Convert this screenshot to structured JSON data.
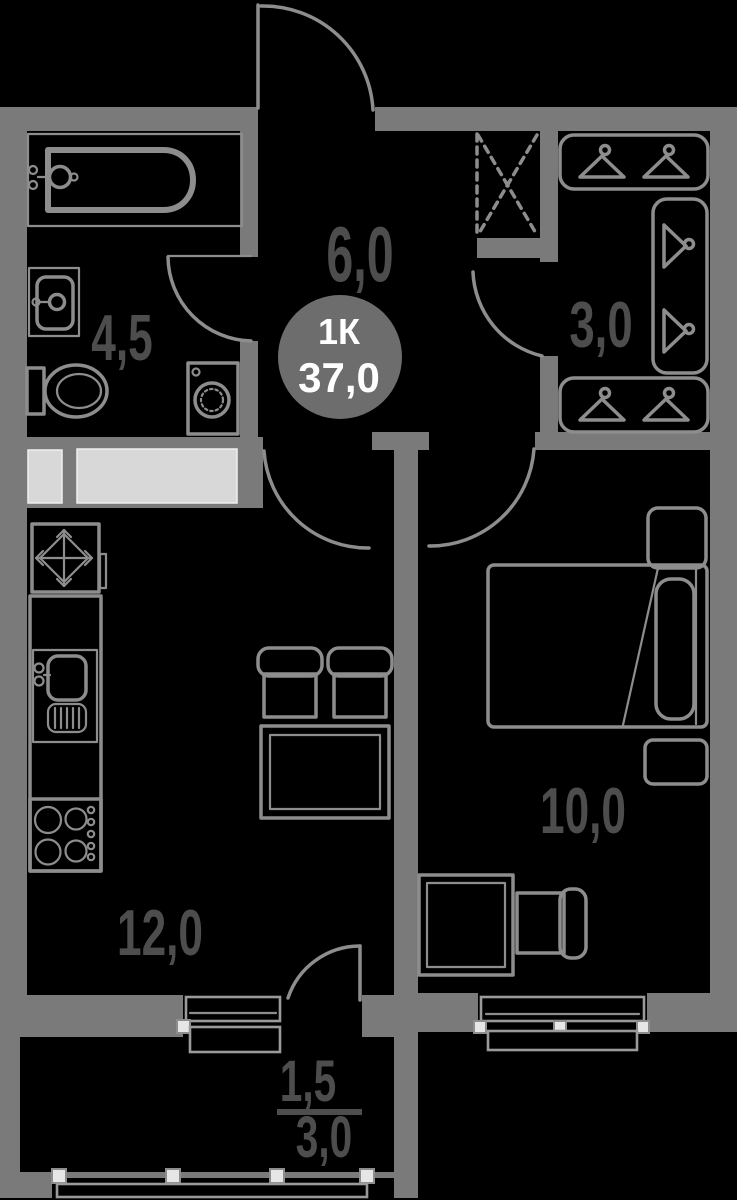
{
  "floorplan": {
    "badge": {
      "type": "1К",
      "total_area": "37,0"
    },
    "rooms": {
      "bathroom": {
        "area": "4,5"
      },
      "hallway": {
        "area": "6,0"
      },
      "wardrobe": {
        "area": "3,0"
      },
      "kitchen_living": {
        "area": "12,0"
      },
      "bedroom": {
        "area": "10,0"
      },
      "balcony": {
        "area_coefficient": "1,5",
        "area_total": "3,0"
      }
    },
    "icons": {
      "fridge": "snowflake-icon",
      "ventilation_shaft": "dashed-cross-icon",
      "wardrobe_storage": "hanger-icons"
    },
    "colors": {
      "background": "#000000",
      "walls": "#7a7a7a",
      "lines": "#8d8d8d",
      "labels": "#4d4d4d",
      "badge_fill": "#6d6d6d",
      "badge_text": "#ffffff",
      "cabinet_fill": "#d8d8d8",
      "glazing_post": "#e6e6e6"
    }
  }
}
